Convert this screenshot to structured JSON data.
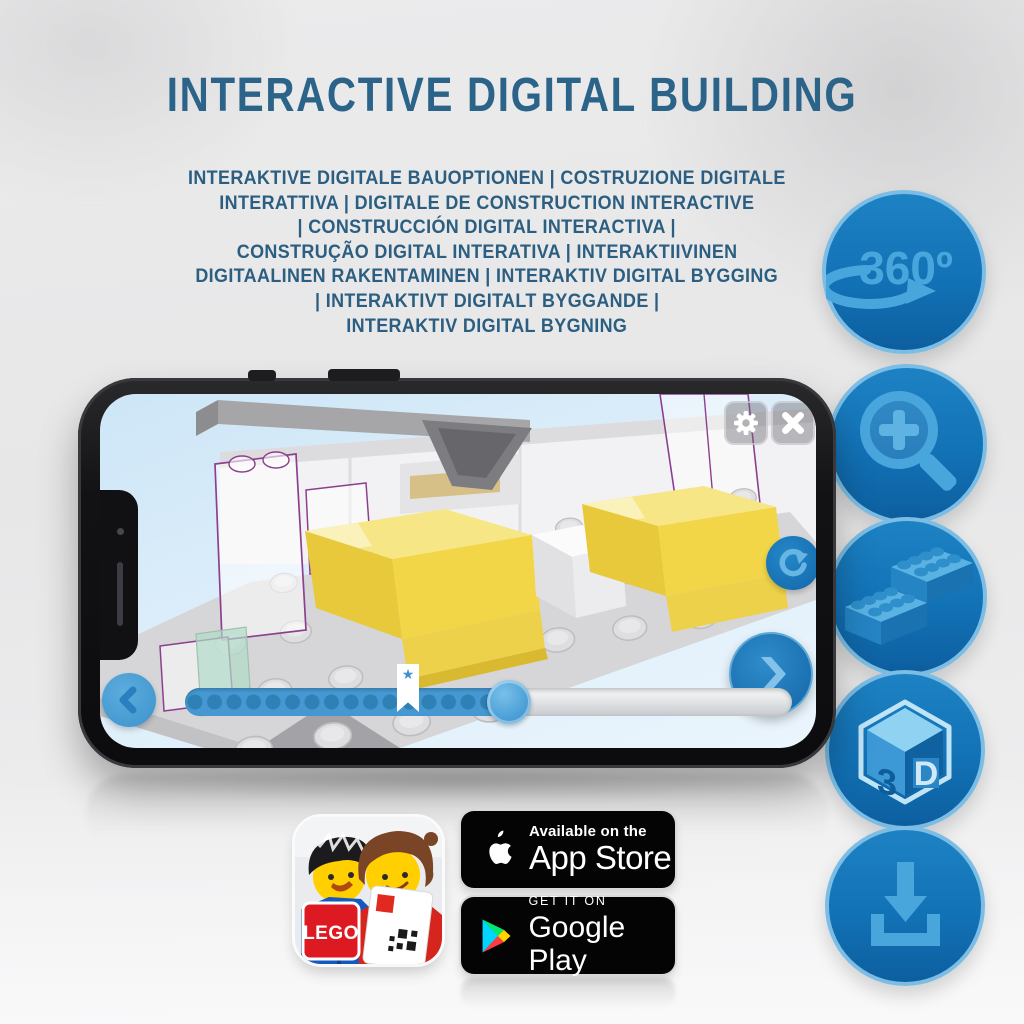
{
  "title": "INTERACTIVE DIGITAL BUILDING",
  "subtitle_lines": [
    "INTERAKTIVE DIGITALE BAUOPTIONEN | COSTRUZIONE DIGITALE",
    "INTERATTIVA | DIGITALE DE CONSTRUCTION INTERACTIVE",
    "| CONSTRUCCIÓN DIGITAL INTERACTIVA |",
    "CONSTRUÇÃO DIGITAL INTERATIVA | INTERAKTIIVINEN",
    "DIGITAALINEN RAKENTAMINEN | INTERAKTIV DIGITAL BYGGING",
    "| INTERAKTIVT DIGITALT BYGGANDE |",
    "INTERAKTIV DIGITAL BYGNING"
  ],
  "feature_icons": [
    {
      "icon": "360-rotation-icon",
      "label": "360º"
    },
    {
      "icon": "zoom-in-icon"
    },
    {
      "icon": "lego-brick-icon"
    },
    {
      "icon": "3d-cube-icon",
      "left": "3",
      "right": "D"
    },
    {
      "icon": "download-icon"
    }
  ],
  "phone_app": {
    "controls": [
      "settings",
      "close",
      "rotate",
      "previous",
      "next"
    ],
    "slider": {
      "progress_percent": 54,
      "milestone_percent": 37,
      "milestone_marker": "★"
    }
  },
  "app_icon": {
    "logo_text": "LEGO"
  },
  "store_badges": {
    "app_store": {
      "tagline": "Available on the",
      "name": "App Store"
    },
    "google_play": {
      "tagline": "GET IT ON",
      "name": "Google Play"
    }
  },
  "colors": {
    "title_blue": "#2b6389",
    "subtitle_blue": "#2b5e80",
    "circle_blue": "#1272b6",
    "glyph_blue": "#49a6dd",
    "bed_yellow": "#f2d648",
    "ghost_outline_purple": "#8d3f8f",
    "badge_black": "#040404"
  }
}
